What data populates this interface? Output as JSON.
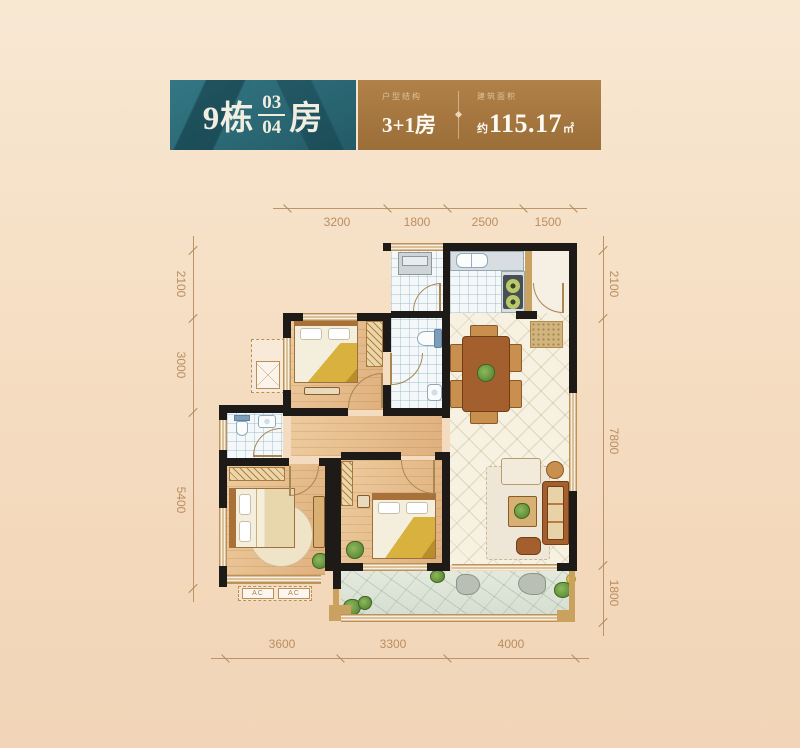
{
  "header": {
    "building": "9栋",
    "unit_top": "03",
    "unit_bottom": "04",
    "suffix": "房",
    "type_caption": "户型结构",
    "type_value": "3+1房",
    "area_caption": "建筑面积",
    "area_approx": "约",
    "area_value": "115.17",
    "area_unit": "㎡"
  },
  "dimensions": {
    "top": [
      "3200",
      "1800",
      "2500",
      "1500"
    ],
    "left": [
      "2100",
      "3000",
      "5400"
    ],
    "right": [
      "2100",
      "7800",
      "1800"
    ],
    "bottom": [
      "3600",
      "3300",
      "4000"
    ]
  },
  "labels": {
    "ac": "AC"
  },
  "colors": {
    "teal": "#2b6974",
    "bronze": "#a87a42",
    "wall": "#1d1a17",
    "dimension_text": "#b98e60",
    "background_top": "#f8e8d3",
    "background_bottom": "#f2d5b8"
  }
}
